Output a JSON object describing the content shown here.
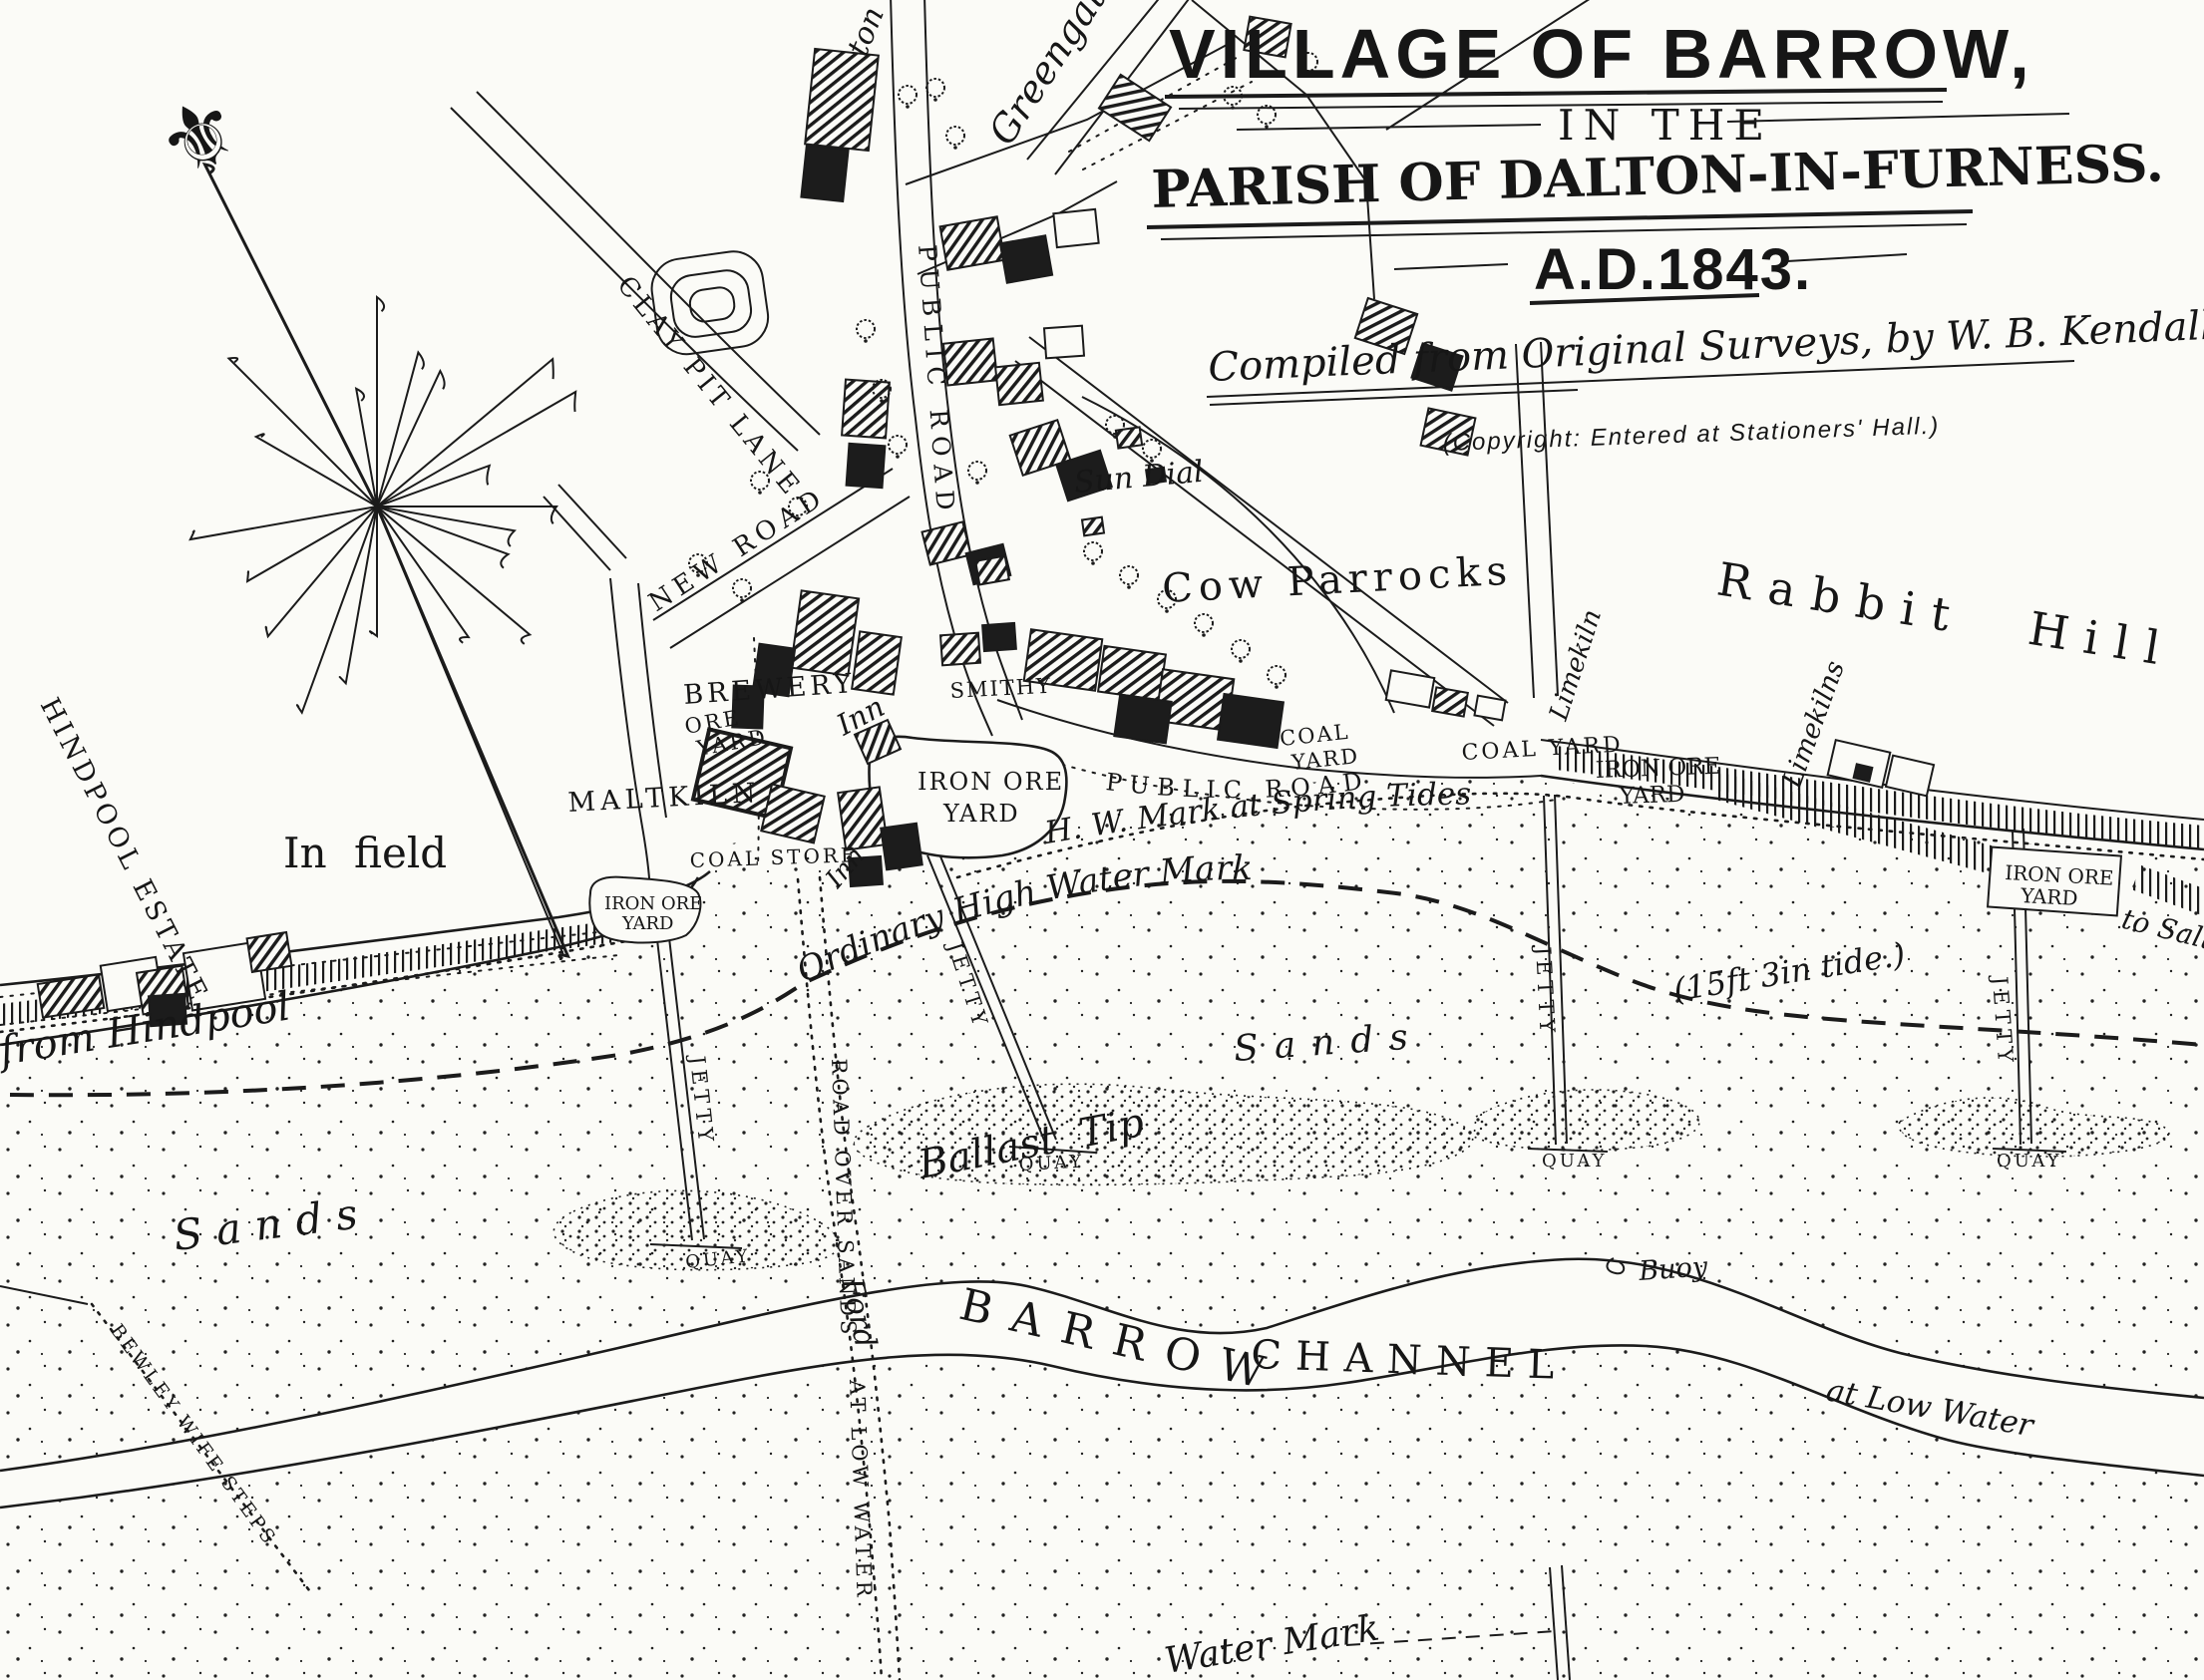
{
  "title_block": {
    "line1": "VILLAGE OF BARROW,",
    "line2": "IN THE",
    "line3": "PARISH OF DALTON-IN-FURNESS.",
    "line4": "A.D.1843.",
    "compiled_by": "Compiled from Original Surveys, by W. B. Kendall, C.E.",
    "copyright": "(Copyright:  Entered  at  Stationers' Hall.)"
  },
  "icons": {
    "fleur_de_lis": "⚜"
  },
  "places": {
    "greengate": "Greengate",
    "road_partial_top_left": "ton",
    "clay_pit_lane": "CLAY PIT LANE",
    "public_road": "PUBLIC ROAD",
    "new_road": "NEW ROAD",
    "sun_dial": "Sun Dial",
    "cow_parrocks": "Cow Parrocks",
    "rabbit_hill": "Rabbit Hill",
    "brewery": "BREWERY",
    "inn": "Inn",
    "smithy": "SMITHY",
    "ore_yard": {
      "l1": "ORE",
      "l2": "YARD"
    },
    "maltkiln": "MALTKILN",
    "coal_store": "COAL STORE",
    "iron_ore_yard": {
      "l1": "IRON ORE",
      "l2": "YARD"
    },
    "coal_yard": {
      "l1": "COAL",
      "l2": "YARD"
    },
    "coal_yard_single": "COAL YARD",
    "limekiln": "Limekiln",
    "limekilns": "Limekilns",
    "hw_spring_tides": "H. W. Mark at Spring Tides",
    "ordinary_hwm": "Ordinary High Water Mark",
    "tide_note": "(15ft 3in tide.)",
    "jetty": "JETTY",
    "quay": "QUAY",
    "sands": "Sands",
    "ballast_tip": "Ballast Tip",
    "buoy": "Buoy",
    "barrow": "BARROW",
    "channel": "CHANNEL",
    "at_low_water": "at  Low  Water",
    "from_hindpool": "from Hindpool",
    "hindpool_estate": "HINDPOOL ESTATE",
    "in_field": "In field",
    "bewley_wife_steps": "BEWLEY WIFE STEPS",
    "road_over_sands": "ROAD OVER SANDS",
    "road_at_low_water": "AT LOW WATER",
    "ford": "Ford",
    "to_salthouse_partial": "to Salth",
    "water_mark_partial": "Water Mark"
  }
}
